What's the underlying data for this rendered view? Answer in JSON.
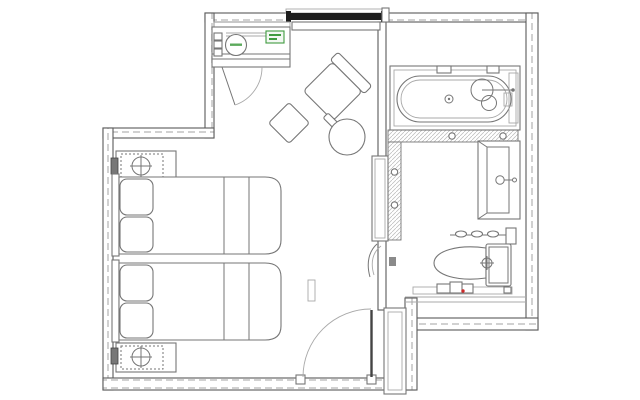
{
  "plan": {
    "kind": "hotel-guestroom-floor-plan",
    "colors": {
      "paper": "#ffffff",
      "wall_line": "#5a5a5a",
      "detail_line": "#767676",
      "light_line": "#a9a9a9",
      "hatch": "#c6c6c6",
      "window_dark": "#1e1e1e",
      "accent_green": "#3f9b3f",
      "accent_red": "#cc2a2a"
    },
    "areas": [
      {
        "name": "bedroom-lounge"
      },
      {
        "name": "bathroom"
      },
      {
        "name": "entry"
      }
    ],
    "fixtures": [
      "window",
      "minibar-cabinet",
      "kettle",
      "minibar-label",
      "lounge-armchair",
      "side-table",
      "round-table",
      "nightstand-lamp-top",
      "bed-1",
      "bed-2",
      "nightstand-lamp-bottom",
      "bathtub",
      "tub-faucet",
      "vanity-sink",
      "towel-rail",
      "toilet",
      "bath-shelf",
      "tiled-partition",
      "sliding-door",
      "curved-door",
      "entry-door",
      "closet"
    ]
  }
}
